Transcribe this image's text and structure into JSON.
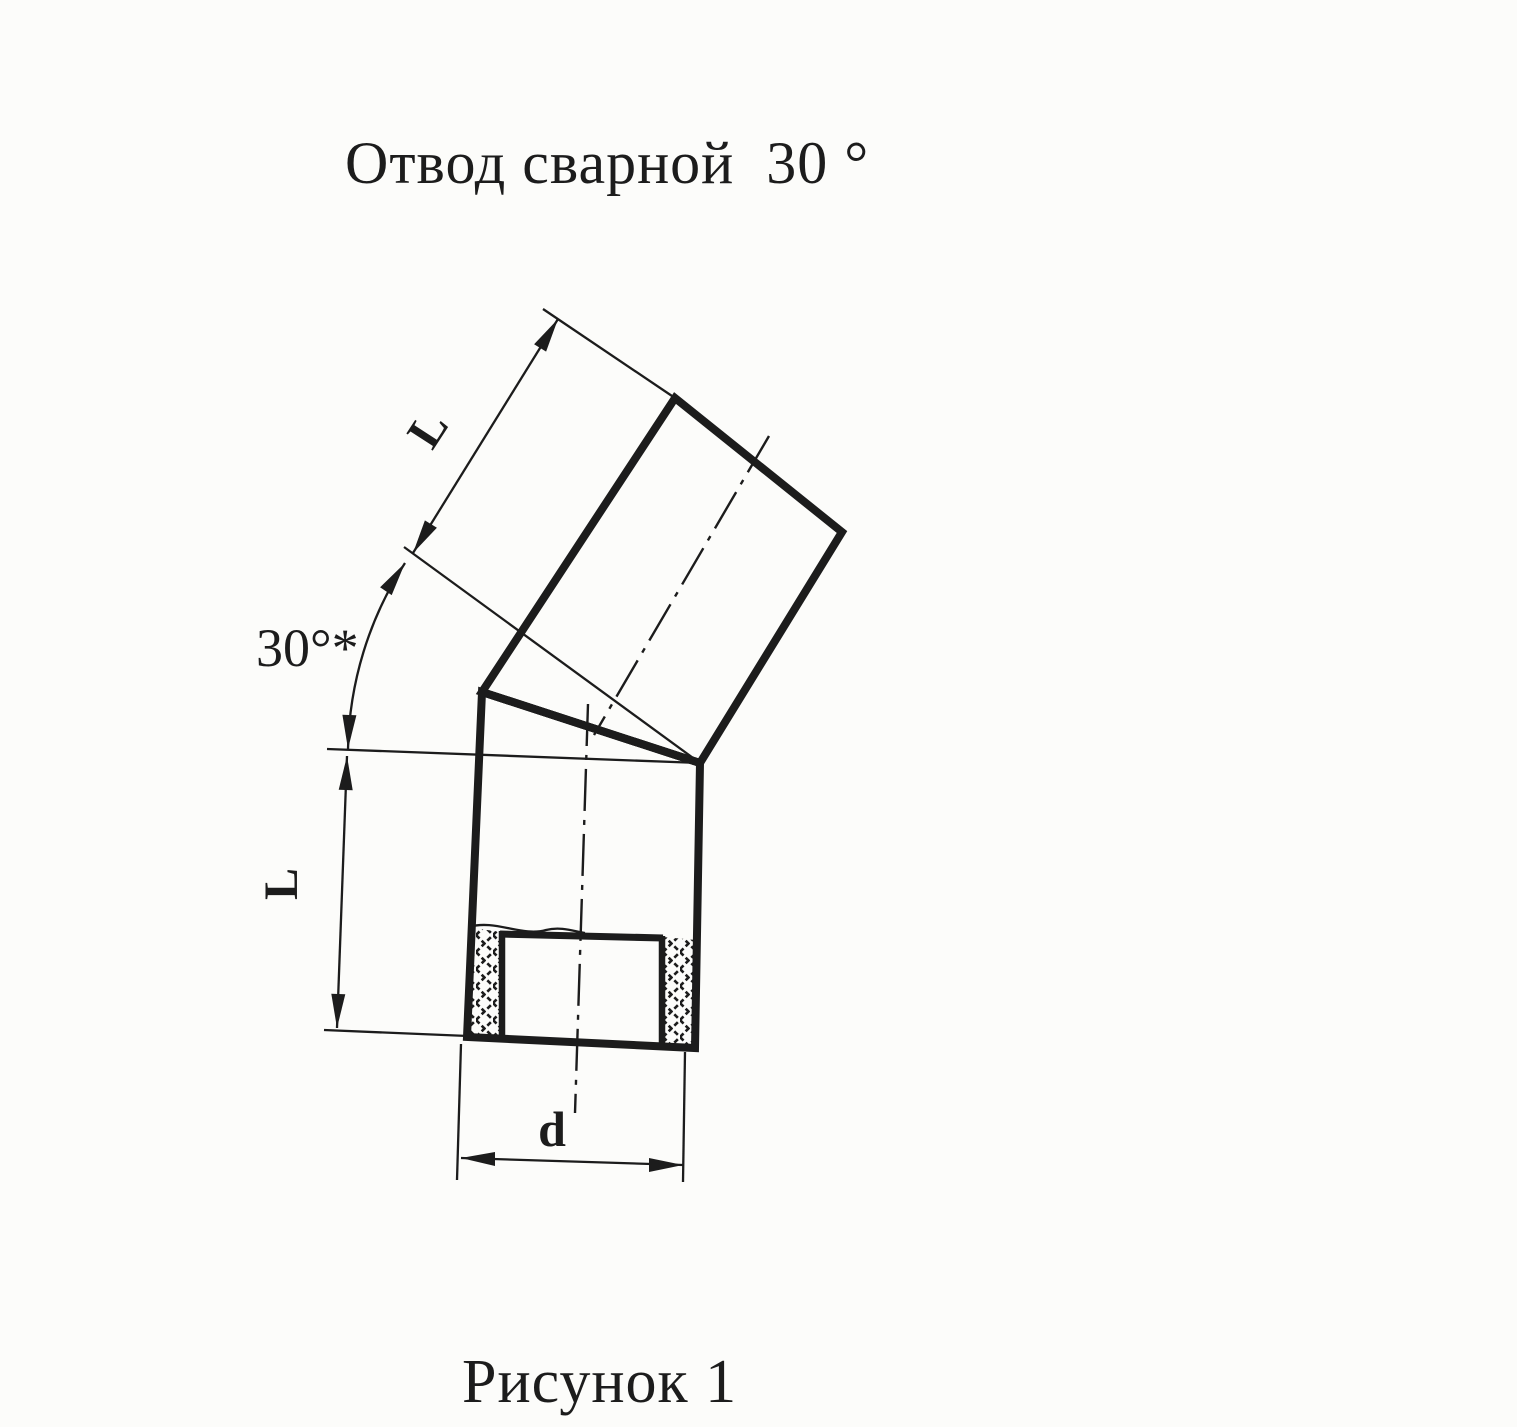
{
  "title": "Отвод сварной  30 °",
  "caption": "Рисунок 1",
  "labels": {
    "angle": "30°*",
    "length_upper": "L",
    "length_lower": "L",
    "diameter": "d"
  },
  "drawing": {
    "description": "Welded pipe elbow 30 degrees, two mitred segments, sectioned lower end with cross-hatched walls",
    "angle_value_deg": 30,
    "segment_count": 2
  },
  "colors": {
    "ink": "#1c1c1c",
    "paper": "#fcfcfa"
  }
}
